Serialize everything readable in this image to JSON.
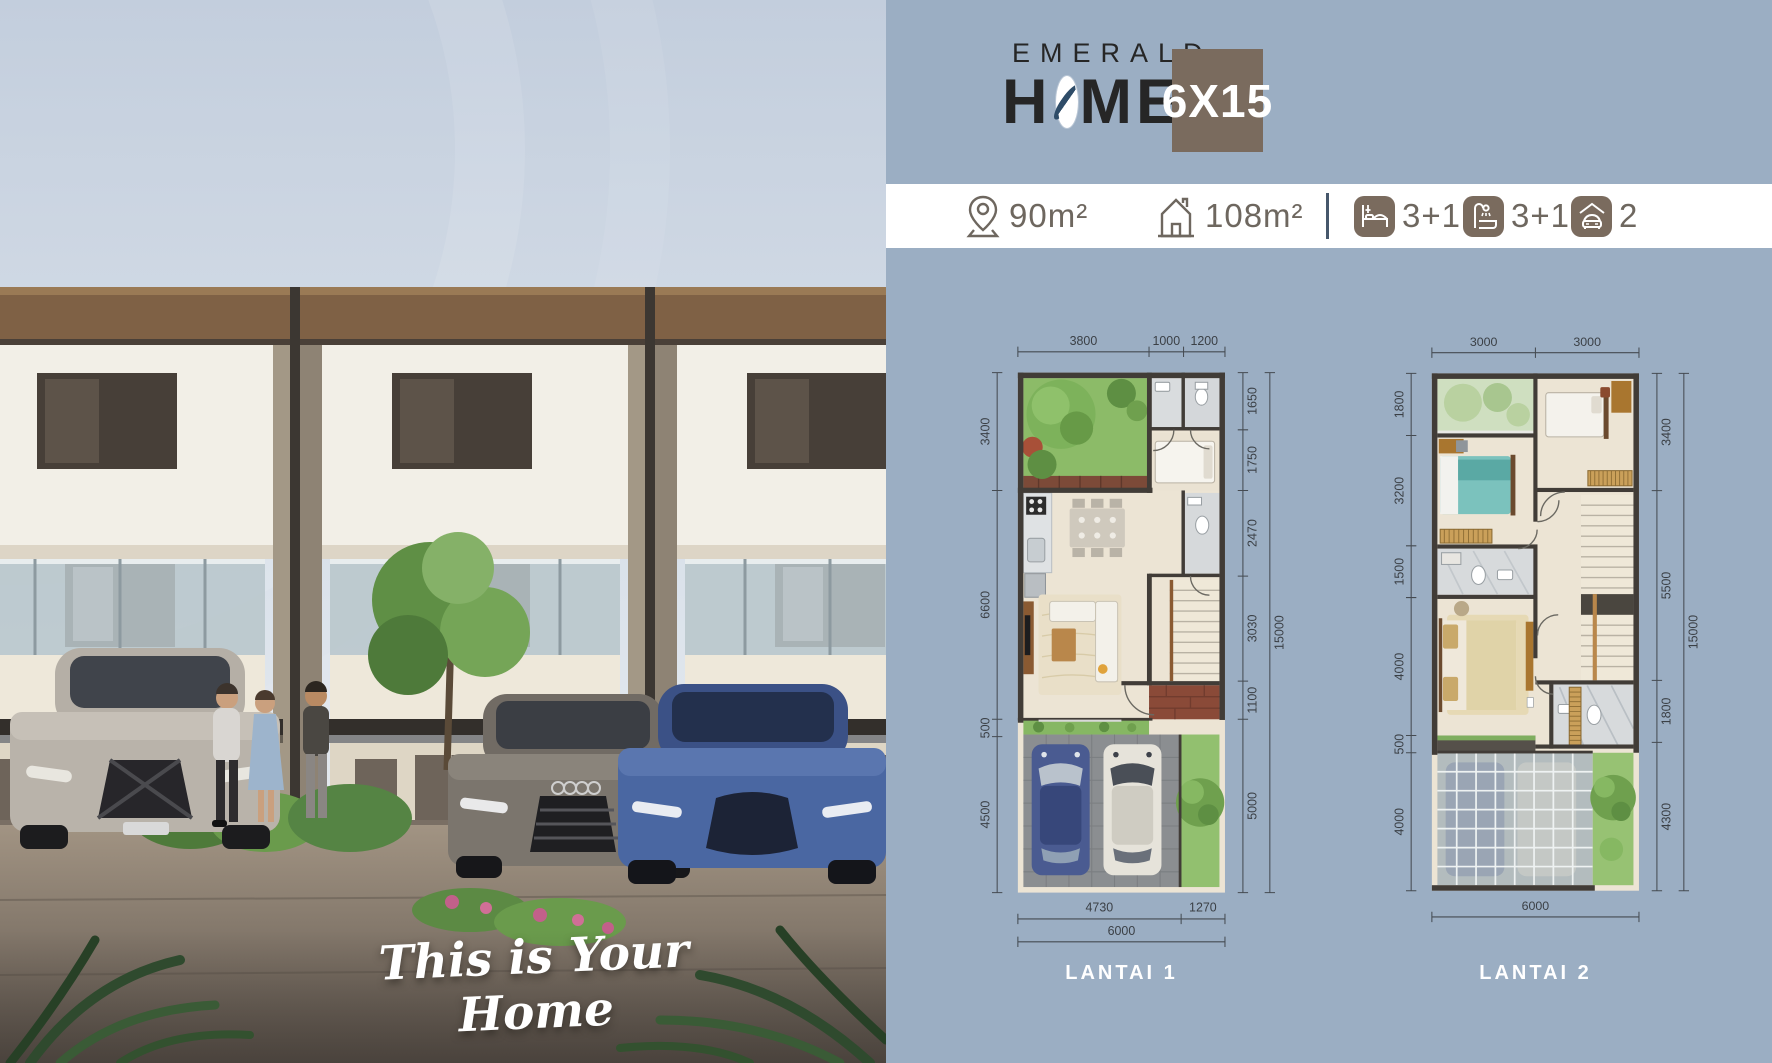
{
  "brand": {
    "emerald": "EMERALD",
    "home_prefix": "H",
    "home_suffix": "ME",
    "size": "6X15"
  },
  "specs": {
    "land_area": "90m²",
    "building_area": "108m²",
    "bedrooms": "3+1",
    "bathrooms": "3+1",
    "carport": "2"
  },
  "photo": {
    "tagline": "This is Your Home"
  },
  "colors": {
    "panel_bg": "#9BAEC3",
    "badge_bg": "#7A6B5E",
    "logo_ring": "#2E4C68"
  },
  "plans": [
    {
      "caption": "LANTAI 1",
      "dims_top": [
        "3800",
        "1000",
        "1200"
      ],
      "dims_left": [
        "3400",
        "6600",
        "500",
        "4500"
      ],
      "dims_right": [
        "1650",
        "1750",
        "2470",
        "3030",
        "1100",
        "5000"
      ],
      "dims_right_total": "15000",
      "dims_bottom": [
        "4730",
        "1270"
      ],
      "dims_bottom_total": "6000"
    },
    {
      "caption": "LANTAI 2",
      "dims_top": [
        "3000",
        "3000"
      ],
      "dims_left": [
        "1800",
        "3200",
        "1500",
        "4000",
        "500",
        "4000"
      ],
      "dims_right": [
        "3400",
        "5500",
        "1800",
        "4300"
      ],
      "dims_right_total": "15000",
      "dims_bottom_total": "6000"
    }
  ]
}
